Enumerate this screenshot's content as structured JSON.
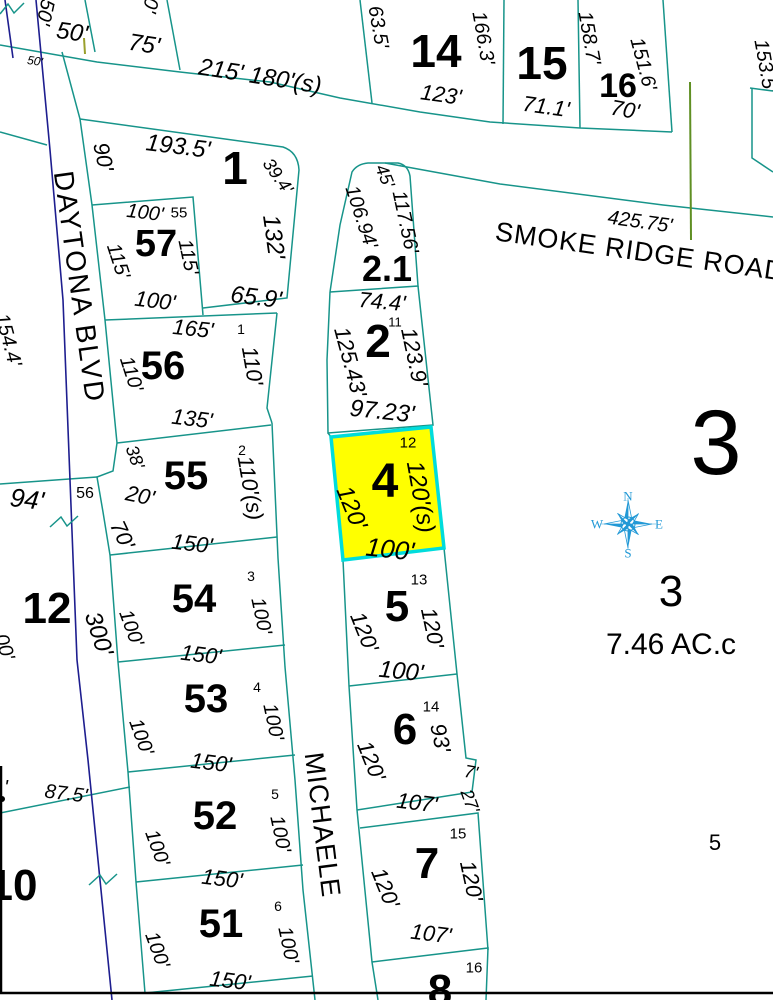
{
  "map": {
    "type": "parcel-plat-map",
    "streets": [
      {
        "name": "SMOKE RIDGE ROAD"
      },
      {
        "name": "DAYTONA BLVD"
      },
      {
        "name": "MICHAELE"
      }
    ],
    "highlighted_parcel": {
      "lot": "4",
      "fill": "#ffff00",
      "stroke": "#00dcdc",
      "dimensions": [
        "120'",
        "120'(s)",
        "100'"
      ],
      "sub_number": "12"
    },
    "parcel_3_area": "7.46 AC.c",
    "colors": {
      "parcel_line": "#17948a",
      "centerline": "#1e1e8f",
      "survey_line": "#5f8f23",
      "tick_line": "#9aa02c",
      "highlight_fill": "#ffff00",
      "highlight_stroke": "#00dcdc",
      "compass": "#2299d6",
      "text": "#000000",
      "background": "#ffffff"
    },
    "compass_directions": [
      "N",
      "E",
      "S",
      "W"
    ],
    "labels": [
      {
        "t": "50'",
        "x": 45,
        "y": 12,
        "r": 102,
        "s": 20,
        "i": 1,
        "k": "dim"
      },
      {
        "t": "0'",
        "x": 150,
        "y": 5,
        "r": 102,
        "s": 20,
        "i": 1,
        "k": "dim"
      },
      {
        "t": "50'",
        "x": 72,
        "y": 33,
        "r": 8,
        "s": 24,
        "i": 1,
        "k": "dim"
      },
      {
        "t": "50'",
        "x": 35,
        "y": 61,
        "r": 8,
        "s": 12,
        "i": 1,
        "k": "dim"
      },
      {
        "t": "75'",
        "x": 144,
        "y": 45,
        "r": 9,
        "s": 24,
        "i": 1,
        "k": "dim"
      },
      {
        "t": "215' 180'(s)",
        "x": 260,
        "y": 77,
        "r": 9,
        "s": 24,
        "i": 1,
        "k": "dim"
      },
      {
        "t": "14",
        "x": 436,
        "y": 51,
        "s": 46,
        "b": 1,
        "k": "lot"
      },
      {
        "t": "63.5'",
        "x": 378,
        "y": 27,
        "r": 80,
        "s": 20,
        "i": 1,
        "k": "dim"
      },
      {
        "t": "166.3'",
        "x": 483,
        "y": 38,
        "r": 80,
        "s": 20,
        "i": 1,
        "k": "dim"
      },
      {
        "t": "123'",
        "x": 441,
        "y": 95,
        "r": 8,
        "s": 22,
        "i": 1,
        "k": "dim"
      },
      {
        "t": "15",
        "x": 542,
        "y": 63,
        "s": 46,
        "b": 1,
        "k": "lot"
      },
      {
        "t": "71.1'",
        "x": 546,
        "y": 107,
        "r": 8,
        "s": 22,
        "i": 1,
        "k": "dim"
      },
      {
        "t": "158.7'",
        "x": 589,
        "y": 38,
        "r": 80,
        "s": 20,
        "i": 1,
        "k": "dim"
      },
      {
        "t": "16",
        "x": 618,
        "y": 86,
        "s": 34,
        "b": 1,
        "k": "lot"
      },
      {
        "t": "151.6'",
        "x": 643,
        "y": 64,
        "r": 75,
        "s": 20,
        "i": 1,
        "k": "dim"
      },
      {
        "t": "70'",
        "x": 625,
        "y": 110,
        "r": 10,
        "s": 22,
        "i": 1,
        "k": "dim"
      },
      {
        "t": "153.5'",
        "x": 765,
        "y": 66,
        "r": 80,
        "s": 20,
        "i": 1,
        "k": "dim"
      },
      {
        "t": "425.75'",
        "x": 640,
        "y": 222,
        "r": 8,
        "s": 20,
        "i": 1,
        "k": "dim"
      },
      {
        "t": "SMOKE RIDGE ROAD",
        "x": 640,
        "y": 252,
        "r": 8,
        "s": 27,
        "ls": 1,
        "k": "street"
      },
      {
        "t": "193.5'",
        "x": 178,
        "y": 147,
        "r": 7,
        "s": 24,
        "i": 1,
        "k": "dim"
      },
      {
        "t": "1",
        "x": 235,
        "y": 168,
        "s": 46,
        "b": 1,
        "k": "lot"
      },
      {
        "t": "39.4'",
        "x": 278,
        "y": 176,
        "r": 55,
        "s": 18,
        "i": 1,
        "k": "dim"
      },
      {
        "t": "90'",
        "x": 103,
        "y": 157,
        "r": 78,
        "s": 22,
        "i": 1,
        "k": "dim"
      },
      {
        "t": "132'",
        "x": 273,
        "y": 237,
        "r": 82,
        "s": 24,
        "i": 1,
        "k": "dim"
      },
      {
        "t": "65.9'",
        "x": 256,
        "y": 298,
        "r": 7,
        "s": 24,
        "i": 1,
        "k": "dim"
      },
      {
        "t": "100'",
        "x": 145,
        "y": 213,
        "r": 7,
        "s": 20,
        "i": 1,
        "k": "dim"
      },
      {
        "t": "55",
        "x": 179,
        "y": 213,
        "s": 15,
        "k": "sub"
      },
      {
        "t": "57",
        "x": 156,
        "y": 244,
        "s": 38,
        "b": 1,
        "k": "lot"
      },
      {
        "t": "115'",
        "x": 118,
        "y": 261,
        "r": 72,
        "s": 20,
        "i": 1,
        "k": "dim"
      },
      {
        "t": "115'",
        "x": 188,
        "y": 257,
        "r": 78,
        "s": 20,
        "i": 1,
        "k": "dim"
      },
      {
        "t": "100'",
        "x": 155,
        "y": 301,
        "r": 7,
        "s": 22,
        "i": 1,
        "k": "dim"
      },
      {
        "t": "165'",
        "x": 193,
        "y": 329,
        "r": 6,
        "s": 22,
        "i": 1,
        "k": "dim"
      },
      {
        "t": "1",
        "x": 241,
        "y": 329,
        "s": 14,
        "k": "sub"
      },
      {
        "t": "56",
        "x": 163,
        "y": 366,
        "s": 40,
        "b": 1,
        "k": "lot"
      },
      {
        "t": "110'",
        "x": 131,
        "y": 374,
        "r": 72,
        "s": 20,
        "i": 1,
        "k": "dim"
      },
      {
        "t": "110'",
        "x": 252,
        "y": 366,
        "r": 80,
        "s": 22,
        "i": 1,
        "k": "dim"
      },
      {
        "t": "135'",
        "x": 192,
        "y": 419,
        "r": 7,
        "s": 22,
        "i": 1,
        "k": "dim"
      },
      {
        "t": "2",
        "x": 242,
        "y": 450,
        "s": 14,
        "k": "sub"
      },
      {
        "t": "55",
        "x": 186,
        "y": 476,
        "s": 40,
        "b": 1,
        "k": "lot"
      },
      {
        "t": "38'",
        "x": 135,
        "y": 457,
        "r": 70,
        "s": 18,
        "i": 1,
        "k": "dim"
      },
      {
        "t": "20'",
        "x": 140,
        "y": 496,
        "r": 12,
        "s": 22,
        "i": 1,
        "k": "dim"
      },
      {
        "t": "70'",
        "x": 122,
        "y": 535,
        "r": 65,
        "s": 22,
        "i": 1,
        "k": "dim"
      },
      {
        "t": "110'(s)",
        "x": 250,
        "y": 488,
        "r": 80,
        "s": 22,
        "i": 1,
        "k": "dim"
      },
      {
        "t": "150'",
        "x": 192,
        "y": 544,
        "r": 7,
        "s": 22,
        "i": 1,
        "k": "dim"
      },
      {
        "t": "3",
        "x": 251,
        "y": 576,
        "s": 14,
        "k": "sub"
      },
      {
        "t": "54",
        "x": 194,
        "y": 599,
        "s": 40,
        "b": 1,
        "k": "lot"
      },
      {
        "t": "100'",
        "x": 131,
        "y": 628,
        "r": 70,
        "s": 20,
        "i": 1,
        "k": "dim"
      },
      {
        "t": "100'",
        "x": 261,
        "y": 616,
        "r": 78,
        "s": 20,
        "i": 1,
        "k": "dim"
      },
      {
        "t": "150'",
        "x": 201,
        "y": 655,
        "r": 7,
        "s": 22,
        "i": 1,
        "k": "dim"
      },
      {
        "t": "4",
        "x": 257,
        "y": 687,
        "s": 14,
        "k": "sub"
      },
      {
        "t": "53",
        "x": 206,
        "y": 699,
        "s": 40,
        "b": 1,
        "k": "lot"
      },
      {
        "t": "100'",
        "x": 141,
        "y": 737,
        "r": 70,
        "s": 20,
        "i": 1,
        "k": "dim"
      },
      {
        "t": "100'",
        "x": 273,
        "y": 722,
        "r": 78,
        "s": 20,
        "i": 1,
        "k": "dim"
      },
      {
        "t": "150'",
        "x": 211,
        "y": 763,
        "r": 7,
        "s": 22,
        "i": 1,
        "k": "dim"
      },
      {
        "t": "5",
        "x": 275,
        "y": 794,
        "s": 14,
        "k": "sub"
      },
      {
        "t": "52",
        "x": 215,
        "y": 816,
        "s": 40,
        "b": 1,
        "k": "lot"
      },
      {
        "t": "100'",
        "x": 157,
        "y": 848,
        "r": 70,
        "s": 20,
        "i": 1,
        "k": "dim"
      },
      {
        "t": "100'",
        "x": 280,
        "y": 834,
        "r": 78,
        "s": 20,
        "i": 1,
        "k": "dim"
      },
      {
        "t": "150'",
        "x": 222,
        "y": 879,
        "r": 7,
        "s": 22,
        "i": 1,
        "k": "dim"
      },
      {
        "t": "6",
        "x": 278,
        "y": 906,
        "s": 14,
        "k": "sub"
      },
      {
        "t": "51",
        "x": 221,
        "y": 924,
        "s": 40,
        "b": 1,
        "k": "lot"
      },
      {
        "t": "100'",
        "x": 157,
        "y": 950,
        "r": 70,
        "s": 20,
        "i": 1,
        "k": "dim"
      },
      {
        "t": "100'",
        "x": 288,
        "y": 945,
        "r": 78,
        "s": 20,
        "i": 1,
        "k": "dim"
      },
      {
        "t": "150'",
        "x": 230,
        "y": 981,
        "r": 7,
        "s": 22,
        "i": 1,
        "k": "dim"
      },
      {
        "t": "DAYTONA BLVD",
        "x": 79,
        "y": 287,
        "r": 82,
        "s": 28,
        "ls": 2,
        "k": "street"
      },
      {
        "t": "MICHAELE",
        "x": 322,
        "y": 825,
        "r": 83,
        "s": 27,
        "ls": 1,
        "k": "street"
      },
      {
        "t": "45'",
        "x": 385,
        "y": 176,
        "r": 68,
        "s": 18,
        "i": 1,
        "k": "dim"
      },
      {
        "t": "117.56'",
        "x": 405,
        "y": 222,
        "r": 78,
        "s": 20,
        "i": 1,
        "k": "dim"
      },
      {
        "t": "106.94'",
        "x": 361,
        "y": 217,
        "r": 72,
        "s": 20,
        "i": 1,
        "k": "dim"
      },
      {
        "t": "2.1",
        "x": 387,
        "y": 269,
        "s": 36,
        "b": 1,
        "k": "lot"
      },
      {
        "t": "74.4'",
        "x": 382,
        "y": 302,
        "r": 5,
        "s": 22,
        "i": 1,
        "k": "dim"
      },
      {
        "t": "2",
        "x": 378,
        "y": 341,
        "s": 46,
        "b": 1,
        "k": "lot"
      },
      {
        "t": "11",
        "x": 395,
        "y": 322,
        "s": 13,
        "k": "sub"
      },
      {
        "t": "123.9'",
        "x": 414,
        "y": 357,
        "r": 78,
        "s": 22,
        "i": 1,
        "k": "dim"
      },
      {
        "t": "125.43'",
        "x": 350,
        "y": 362,
        "r": 75,
        "s": 22,
        "i": 1,
        "k": "dim"
      },
      {
        "t": "97.23'",
        "x": 382,
        "y": 412,
        "r": 6,
        "s": 24,
        "i": 1,
        "k": "dim"
      },
      {
        "t": "12",
        "x": 408,
        "y": 443,
        "s": 15,
        "k": "sub"
      },
      {
        "t": "4",
        "x": 385,
        "y": 482,
        "s": 48,
        "b": 1,
        "k": "lot"
      },
      {
        "t": "120'",
        "x": 351,
        "y": 508,
        "r": 68,
        "s": 24,
        "i": 1,
        "k": "dim"
      },
      {
        "t": "120'(s)",
        "x": 420,
        "y": 497,
        "r": 80,
        "s": 24,
        "i": 1,
        "k": "dim"
      },
      {
        "t": "100'",
        "x": 390,
        "y": 549,
        "r": 6,
        "s": 26,
        "i": 1,
        "k": "dim"
      },
      {
        "t": "13",
        "x": 419,
        "y": 580,
        "s": 15,
        "k": "sub"
      },
      {
        "t": "5",
        "x": 397,
        "y": 607,
        "s": 44,
        "b": 1,
        "k": "lot"
      },
      {
        "t": "120'",
        "x": 364,
        "y": 632,
        "r": 68,
        "s": 22,
        "i": 1,
        "k": "dim"
      },
      {
        "t": "120'",
        "x": 432,
        "y": 628,
        "r": 78,
        "s": 22,
        "i": 1,
        "k": "dim"
      },
      {
        "t": "100'",
        "x": 401,
        "y": 672,
        "r": 6,
        "s": 24,
        "i": 1,
        "k": "dim"
      },
      {
        "t": "14",
        "x": 431,
        "y": 707,
        "s": 15,
        "k": "sub"
      },
      {
        "t": "6",
        "x": 405,
        "y": 730,
        "s": 44,
        "b": 1,
        "k": "lot"
      },
      {
        "t": "120'",
        "x": 371,
        "y": 761,
        "r": 68,
        "s": 22,
        "i": 1,
        "k": "dim"
      },
      {
        "t": "93'",
        "x": 440,
        "y": 738,
        "r": 78,
        "s": 22,
        "i": 1,
        "k": "dim"
      },
      {
        "t": "7'",
        "x": 471,
        "y": 772,
        "r": 10,
        "s": 18,
        "i": 1,
        "k": "dim"
      },
      {
        "t": "107'",
        "x": 417,
        "y": 803,
        "r": 7,
        "s": 22,
        "i": 1,
        "k": "dim"
      },
      {
        "t": "27'",
        "x": 470,
        "y": 801,
        "r": 70,
        "s": 18,
        "i": 1,
        "k": "dim"
      },
      {
        "t": "15",
        "x": 458,
        "y": 834,
        "s": 15,
        "k": "sub"
      },
      {
        "t": "7",
        "x": 427,
        "y": 864,
        "s": 44,
        "b": 1,
        "k": "lot"
      },
      {
        "t": "120'",
        "x": 385,
        "y": 888,
        "r": 68,
        "s": 22,
        "i": 1,
        "k": "dim"
      },
      {
        "t": "120'",
        "x": 471,
        "y": 881,
        "r": 78,
        "s": 22,
        "i": 1,
        "k": "dim"
      },
      {
        "t": "107'",
        "x": 431,
        "y": 934,
        "r": 7,
        "s": 22,
        "i": 1,
        "k": "dim"
      },
      {
        "t": "16",
        "x": 474,
        "y": 968,
        "s": 15,
        "k": "sub"
      },
      {
        "t": "8",
        "x": 440,
        "y": 991,
        "s": 44,
        "b": 1,
        "k": "lot"
      },
      {
        "t": "154.4'",
        "x": 8,
        "y": 340,
        "r": 75,
        "s": 20,
        "i": 1,
        "k": "dim"
      },
      {
        "t": "94'",
        "x": 27,
        "y": 499,
        "r": 7,
        "s": 26,
        "i": 1,
        "k": "dim"
      },
      {
        "t": "56",
        "x": 85,
        "y": 494,
        "s": 16,
        "k": "sub"
      },
      {
        "t": "12",
        "x": 47,
        "y": 609,
        "s": 44,
        "b": 1,
        "k": "lot"
      },
      {
        "t": "300'",
        "x": 98,
        "y": 634,
        "r": 72,
        "s": 24,
        "i": 1,
        "k": "dim"
      },
      {
        "t": "00'",
        "x": 4,
        "y": 647,
        "r": 72,
        "s": 20,
        "i": 1,
        "k": "dim"
      },
      {
        "t": "87.5'",
        "x": 66,
        "y": 794,
        "r": 7,
        "s": 20,
        "i": 1,
        "k": "dim"
      },
      {
        "t": "'",
        "x": 6,
        "y": 788,
        "s": 20,
        "i": 1,
        "k": "dim"
      },
      {
        "t": "10",
        "x": 13,
        "y": 886,
        "s": 44,
        "b": 1,
        "k": "lot"
      },
      {
        "t": "3",
        "x": 716,
        "y": 443,
        "s": 92,
        "k": "lot"
      },
      {
        "t": "3",
        "x": 671,
        "y": 592,
        "s": 44,
        "k": "lot"
      },
      {
        "t": "7.46 AC.c",
        "x": 671,
        "y": 645,
        "s": 30,
        "k": "area"
      },
      {
        "t": "5",
        "x": 715,
        "y": 843,
        "s": 22,
        "k": "lot"
      },
      {
        "t": "N",
        "x": 628,
        "y": 496,
        "s": 13,
        "f": 1,
        "c": "#2299d6",
        "k": "compass"
      },
      {
        "t": "E",
        "x": 659,
        "y": 524,
        "s": 13,
        "f": 1,
        "c": "#2299d6",
        "k": "compass"
      },
      {
        "t": "S",
        "x": 628,
        "y": 553,
        "s": 13,
        "f": 1,
        "c": "#2299d6",
        "k": "compass"
      },
      {
        "t": "W",
        "x": 597,
        "y": 524,
        "s": 13,
        "f": 1,
        "c": "#2299d6",
        "k": "compass"
      }
    ]
  }
}
